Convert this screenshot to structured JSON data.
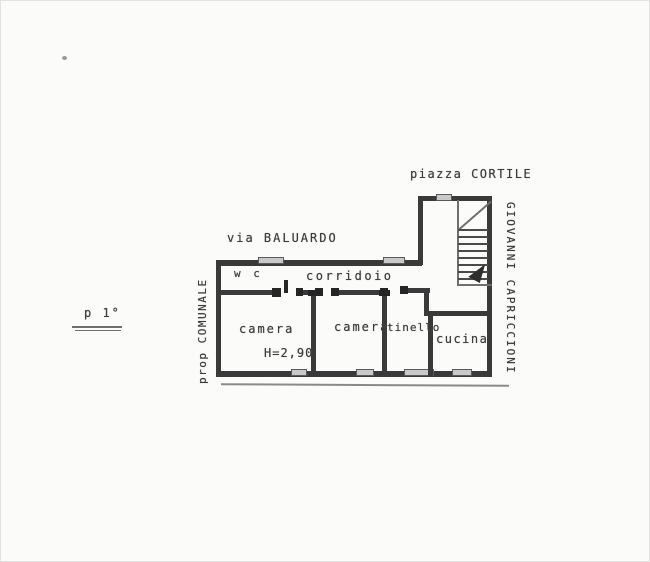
{
  "colors": {
    "background": "#fbfbfa",
    "ink": "#3d3d3d",
    "wall": "#3a3a3a",
    "window_fill": "#c9c9c9",
    "faint_line": "#6f6f6f"
  },
  "annotations": {
    "floor_label": "p 1°",
    "street_top": "via BALUARDO",
    "square_top_right": "piazza CORTILE",
    "owner_left": "prop COMUNALE",
    "owner_right": "GIOVANNI CAPRICCIONI",
    "ceiling_height": "H=2,90"
  },
  "rooms": {
    "wc": "w c",
    "corridor": "corridoio",
    "bedroom1": "camera",
    "bedroom2": "camera",
    "dining": "tinello",
    "kitchen": "cucina"
  }
}
